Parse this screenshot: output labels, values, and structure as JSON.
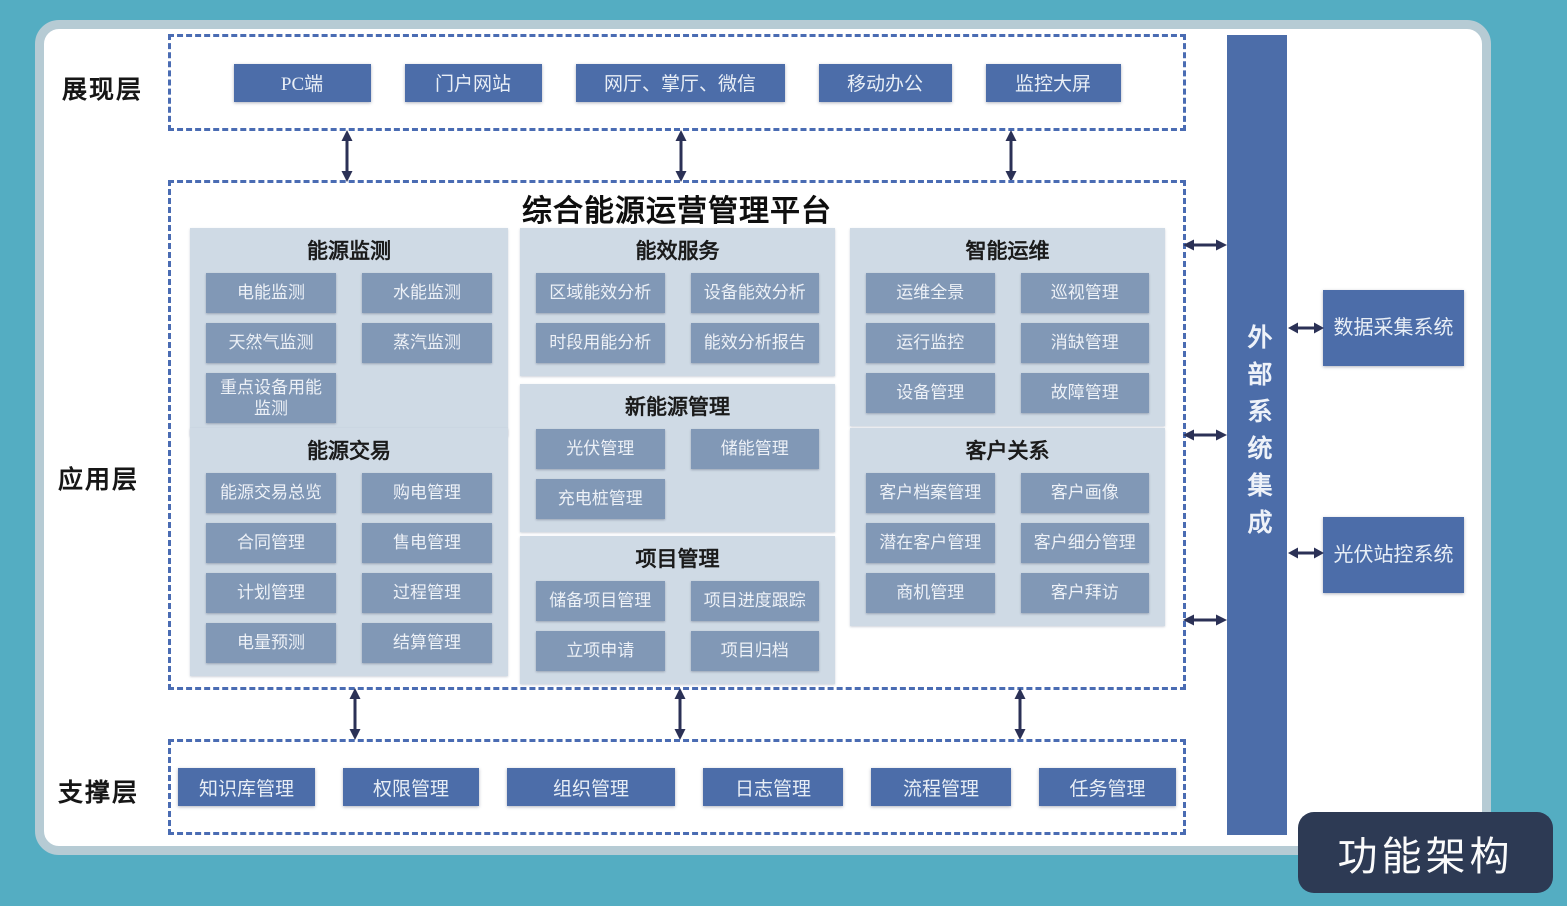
{
  "badge": {
    "label": "功能架构"
  },
  "layers": {
    "presentation": {
      "label": "展现层",
      "items": [
        "PC端",
        "门户网站",
        "网厅、掌厅、微信",
        "移动办公",
        "监控大屏"
      ]
    },
    "application": {
      "label": "应用层",
      "platform_title": "综合能源运营管理平台",
      "sections": [
        {
          "title": "能源监测",
          "items": [
            "电能监测",
            "水能监测",
            "天然气监测",
            "蒸汽监测",
            "重点设备用能监测"
          ]
        },
        {
          "title": "能源交易",
          "items": [
            "能源交易总览",
            "购电管理",
            "合同管理",
            "售电管理",
            "计划管理",
            "过程管理",
            "电量预测",
            "结算管理"
          ]
        },
        {
          "title": "能效服务",
          "items": [
            "区域能效分析",
            "设备能效分析",
            "时段用能分析",
            "能效分析报告"
          ]
        },
        {
          "title": "新能源管理",
          "items": [
            "光伏管理",
            "储能管理",
            "充电桩管理"
          ]
        },
        {
          "title": "项目管理",
          "items": [
            "储备项目管理",
            "项目进度跟踪",
            "立项申请",
            "项目归档"
          ]
        },
        {
          "title": "智能运维",
          "items": [
            "运维全景",
            "巡视管理",
            "运行监控",
            "消缺管理",
            "设备管理",
            "故障管理"
          ]
        },
        {
          "title": "客户关系",
          "items": [
            "客户档案管理",
            "客户画像",
            "潜在客户管理",
            "客户细分管理",
            "商机管理",
            "客户拜访"
          ]
        }
      ]
    },
    "support": {
      "label": "支撑层",
      "items": [
        "知识库管理",
        "权限管理",
        "组织管理",
        "日志管理",
        "流程管理",
        "任务管理"
      ]
    }
  },
  "external": {
    "bar_label": "外部系统集成",
    "systems": [
      "数据采集系统",
      "光伏站控系统"
    ]
  },
  "colors": {
    "background_teal": "#54adc2",
    "panel_border": "#b6cbd4",
    "dashed_border": "#4a6cb3",
    "primary_blue": "#4c6da9",
    "module_blue": "#8198b6",
    "section_bg": "#cfdae5",
    "arrow_navy": "#2b3156",
    "badge_dark": "#2d3a54"
  }
}
